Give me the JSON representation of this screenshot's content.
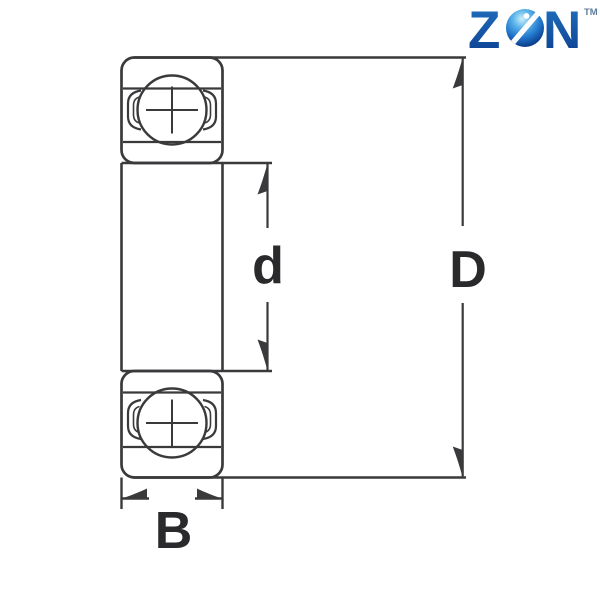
{
  "diagram": {
    "type": "bearing-cross-section",
    "labels": {
      "bore": "d",
      "outer": "D",
      "width": "B"
    }
  },
  "logo": {
    "z": "Z",
    "n": "N",
    "tm": "TM",
    "sphere_icon": "globe-sphere-e-icon"
  },
  "colors": {
    "background": "#ffffff",
    "line": "#3a3a3c",
    "label": "#2a2a2c",
    "logo_blue_top": "#2273c2",
    "logo_blue_bottom": "#0b3c8c",
    "sphere_light": "#cdeefb",
    "sphere_mid_light": "#5ab4ea",
    "sphere_mid": "#2277cc",
    "sphere_dark": "#0c3f8e",
    "sphere_edge": "#092e6e",
    "tm": "#5f7d9a"
  }
}
